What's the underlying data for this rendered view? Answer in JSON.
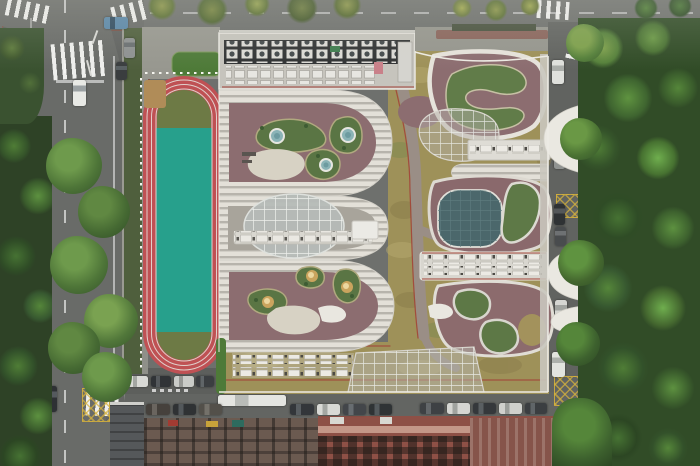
{
  "scene": {
    "type": "aerial-photograph",
    "subject": "school campus with sculpted organic roofscape, running track and sports field, viewed straight down",
    "description": "Top-down drone photograph: a red running track with a bright teal infield on the left; a large school building whose roof is carved into organic courtyards with maroon terraces, dry sedum bands, green planted mounds, circular skylights, a large glazed oval, a dark glazed gym roof and white petal canopies; roads with zebra crossings, channelization islands, parked cars and a white bus frame the block; dense tree canopies line the right side and the bottom streets."
  },
  "palette": {
    "asphalt": "#6e706d",
    "track_red": "#bf5154",
    "field_teal": "#27a08c",
    "infield_olive": "#6d7a45",
    "roof_maroon": "#8c6d70",
    "terrace_light": "#e3e0d8",
    "terrace_dark": "#b7b4ac",
    "dry_sedum": "#9e9159",
    "planting_green": "#5d7846",
    "skylight_teal": "#8ab3b6",
    "dome_amber": "#caa45e",
    "oval_glass": "#b5bbb7",
    "gym_glass_teal": "#4b676b",
    "canopy_white": "#eae8e1",
    "forest_green": "#314c27",
    "apartment_roof_red": "#8e5046",
    "crosswalk_white": "#fafaf8",
    "hatch_yellow": "#d6b23c"
  },
  "regions": {
    "roads": {
      "west_road": "two-way street, dashed centre line, zebra crossings, channelization islands",
      "north_road": "street along the top edge with dashed centre line",
      "east_street": "narrow parking street under overhanging tree canopy",
      "south_street": "street with parallel-parked cars and a white bus"
    },
    "track": {
      "label": "running track",
      "track_color": "red with white lane lines",
      "infield": "teal multi-sport field",
      "ends": "olive grass semicircles",
      "features": [
        "sand pit",
        "white boundary fence",
        "green entry roof"
      ]
    },
    "roof": {
      "north_wing": "rooftop mechanical plant with rows of HVAC fan units",
      "west_wings": "terraced wings with striped balconies wrapping maroon courtyards",
      "courtyard_nw": {
        "green_mounds": 3,
        "teal_skylights": 3,
        "cream_deck": 1,
        "benches": 2
      },
      "courtyard_sw": {
        "green_mounds": 3,
        "amber_dome_skylights": 3,
        "cream_deck": 1
      },
      "oval_skylight": "large glazed ellipse over central hall",
      "gym_roof": "dark glazed rounded-square roof beside kidney planter",
      "ne_courtyard": "winding planted ribbon in maroon court",
      "se_courtyard": "kidney-shaped planters with white-edged paths",
      "south_band": "dry sedum roof with equipment rows and glazed entry skylight",
      "east_canopies": "white petal canopies over the side street",
      "paths": "grey walking paths with thin red trim crossing the sedum roof"
    },
    "surroundings": {
      "right": "dense mixed-green tree canopy",
      "bottom": "apartment blocks with red-brown roofs and dark courtyard grids",
      "crosswalks": 6,
      "yellow_box_markings": 3,
      "channelization_islands": 2
    }
  },
  "objects": {
    "skylights_teal": 3,
    "skylights_amber": 3,
    "white_canopy_petals": 3,
    "vehicles": [
      {
        "name": "car-white-west",
        "x": 73,
        "y": 80,
        "w": 13,
        "h": 26,
        "dir": "v",
        "body": "#e8e9e5",
        "win": "#9aa0a2"
      },
      {
        "name": "car-dark-west",
        "x": 44,
        "y": 386,
        "w": 13,
        "h": 26,
        "dir": "v",
        "body": "#2e3134",
        "win": "#555a5e"
      },
      {
        "name": "truck-blue-north",
        "x": 104,
        "y": 17,
        "w": 24,
        "h": 12,
        "dir": "h",
        "body": "#5a87a8",
        "win": "#2f4b60"
      },
      {
        "name": "car-grey-north",
        "x": 124,
        "y": 38,
        "w": 11,
        "h": 20,
        "dir": "v",
        "body": "#8e9191",
        "win": "#6a6f71"
      },
      {
        "name": "car-dark-north",
        "x": 116,
        "y": 62,
        "w": 11,
        "h": 18,
        "dir": "v",
        "body": "#3a3d3f",
        "win": "#596063"
      },
      {
        "name": "bus-white-south",
        "x": 218,
        "y": 395,
        "w": 68,
        "h": 11,
        "dir": "h",
        "body": "#e4e5e1",
        "win": "#b9bcb8"
      },
      {
        "name": "car-south-1",
        "x": 146,
        "y": 404,
        "w": 24,
        "h": 11,
        "dir": "h",
        "body": "#46413c",
        "win": "#6a655f"
      },
      {
        "name": "car-south-2",
        "x": 173,
        "y": 404,
        "w": 23,
        "h": 11,
        "dir": "h",
        "body": "#2f3234",
        "win": "#53585b"
      },
      {
        "name": "car-south-3",
        "x": 199,
        "y": 404,
        "w": 23,
        "h": 11,
        "dir": "h",
        "body": "#53504a",
        "win": "#74716a"
      },
      {
        "name": "car-south-4",
        "x": 290,
        "y": 404,
        "w": 24,
        "h": 11,
        "dir": "h",
        "body": "#33363a",
        "win": "#585d61"
      },
      {
        "name": "car-south-5",
        "x": 317,
        "y": 404,
        "w": 23,
        "h": 11,
        "dir": "h",
        "body": "#d8d9d5",
        "win": "#a3a6a2"
      },
      {
        "name": "car-south-6",
        "x": 343,
        "y": 404,
        "w": 23,
        "h": 11,
        "dir": "h",
        "body": "#43464a",
        "win": "#686d71"
      },
      {
        "name": "car-south-7",
        "x": 369,
        "y": 404,
        "w": 23,
        "h": 11,
        "dir": "h",
        "body": "#2f3335",
        "win": "#545a5d"
      },
      {
        "name": "car-south-8",
        "x": 420,
        "y": 403,
        "w": 24,
        "h": 11,
        "dir": "h",
        "body": "#3e4144",
        "win": "#63676a"
      },
      {
        "name": "car-south-9",
        "x": 447,
        "y": 403,
        "w": 23,
        "h": 11,
        "dir": "h",
        "body": "#d5d6d2",
        "win": "#a0a39f"
      },
      {
        "name": "car-south-10",
        "x": 473,
        "y": 403,
        "w": 23,
        "h": 11,
        "dir": "h",
        "body": "#35383b",
        "win": "#5a5f62"
      },
      {
        "name": "car-south-11",
        "x": 499,
        "y": 403,
        "w": 23,
        "h": 11,
        "dir": "h",
        "body": "#cfd0cc",
        "win": "#9b9e9a"
      },
      {
        "name": "car-south-12",
        "x": 525,
        "y": 403,
        "w": 22,
        "h": 11,
        "dir": "h",
        "body": "#3b3e41",
        "win": "#606568"
      },
      {
        "name": "car-park-north-1",
        "x": 128,
        "y": 376,
        "w": 20,
        "h": 11,
        "dir": "h",
        "body": "#d8d9d5",
        "win": "#a3a6a2"
      },
      {
        "name": "car-park-north-2",
        "x": 151,
        "y": 376,
        "w": 20,
        "h": 11,
        "dir": "h",
        "body": "#303336",
        "win": "#55595c"
      },
      {
        "name": "car-park-north-3",
        "x": 174,
        "y": 376,
        "w": 20,
        "h": 11,
        "dir": "h",
        "body": "#caccc8",
        "win": "#969894"
      },
      {
        "name": "car-park-north-4",
        "x": 196,
        "y": 376,
        "w": 18,
        "h": 11,
        "dir": "h",
        "body": "#3b3e41",
        "win": "#606568"
      },
      {
        "name": "car-east-1",
        "x": 552,
        "y": 60,
        "w": 12,
        "h": 24,
        "dir": "v",
        "body": "#dfe0dc",
        "win": "#aaada9"
      },
      {
        "name": "car-east-2",
        "x": 554,
        "y": 148,
        "w": 11,
        "h": 21,
        "dir": "v",
        "body": "#909391",
        "win": "#6c6f6d"
      },
      {
        "name": "car-east-3",
        "x": 554,
        "y": 204,
        "w": 11,
        "h": 21,
        "dir": "v",
        "body": "#2f3234",
        "win": "#545759"
      },
      {
        "name": "car-east-4",
        "x": 555,
        "y": 227,
        "w": 11,
        "h": 19,
        "dir": "v",
        "body": "#494c4e",
        "win": "#6e7173"
      },
      {
        "name": "car-east-5",
        "x": 555,
        "y": 300,
        "w": 12,
        "h": 23,
        "dir": "v",
        "body": "#d5d6d2",
        "win": "#a0a39f"
      },
      {
        "name": "car-east-6",
        "x": 552,
        "y": 352,
        "w": 13,
        "h": 25,
        "dir": "v",
        "body": "#e2e3df",
        "win": "#adb0ac"
      }
    ]
  }
}
